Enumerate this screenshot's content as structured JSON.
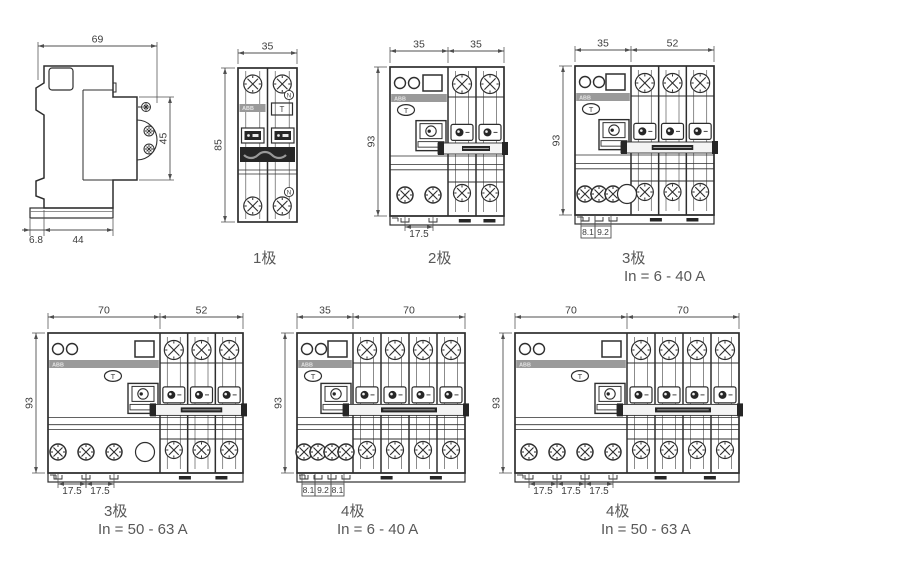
{
  "brand": {
    "logo_text": "ABB",
    "test_button": "T",
    "neutral_mark": "N"
  },
  "colors": {
    "line": "#2e2e2e",
    "thin_line": "#6e6e6e",
    "dimension": "#4f4f4f",
    "logo_band": "#9a9a9a",
    "dark_fill": "#262626",
    "caption_text": "#595959"
  },
  "figures": [
    {
      "id": "side-view",
      "type": "side",
      "dims": {
        "top": "69",
        "right": "45",
        "bottom_left": "6.8",
        "bottom": "44"
      }
    },
    {
      "id": "pole-1",
      "type": "dpn",
      "caption": "1极",
      "dims": {
        "top": "35",
        "left": "85"
      }
    },
    {
      "id": "pole-2",
      "type": "rcbo",
      "caption": "2极",
      "poles": 2,
      "dims": {
        "top_left": "35",
        "top_right": "35",
        "left": "93",
        "bottom": [
          "17.5"
        ]
      }
    },
    {
      "id": "pole-3-6-40",
      "type": "rcbo",
      "caption": "3极",
      "rating": "In = 6 - 40 A",
      "poles": 3,
      "dims": {
        "top_left": "35",
        "top_right": "52",
        "left": "93",
        "bottom": [
          "8.1",
          "9.2"
        ]
      }
    },
    {
      "id": "pole-3-50-63",
      "type": "rcbo",
      "caption": "3极",
      "rating": "In = 50 - 63 A",
      "poles": 3,
      "dims": {
        "top_left": "70",
        "top_right": "52",
        "left": "93",
        "bottom": [
          "17.5",
          "17.5"
        ]
      }
    },
    {
      "id": "pole-4-6-40",
      "type": "rcbo",
      "caption": "4极",
      "rating": "In = 6 - 40 A",
      "poles": 4,
      "dims": {
        "top_left": "35",
        "top_right": "70",
        "left": "93",
        "bottom": [
          "8.1",
          "9.2",
          "8.1"
        ]
      }
    },
    {
      "id": "pole-4-50-63",
      "type": "rcbo",
      "caption": "4极",
      "rating": "In = 50 - 63 A",
      "poles": 4,
      "dims": {
        "top_left": "70",
        "top_right": "70",
        "left": "93",
        "bottom": [
          "17.5",
          "17.5",
          "17.5"
        ]
      }
    }
  ]
}
